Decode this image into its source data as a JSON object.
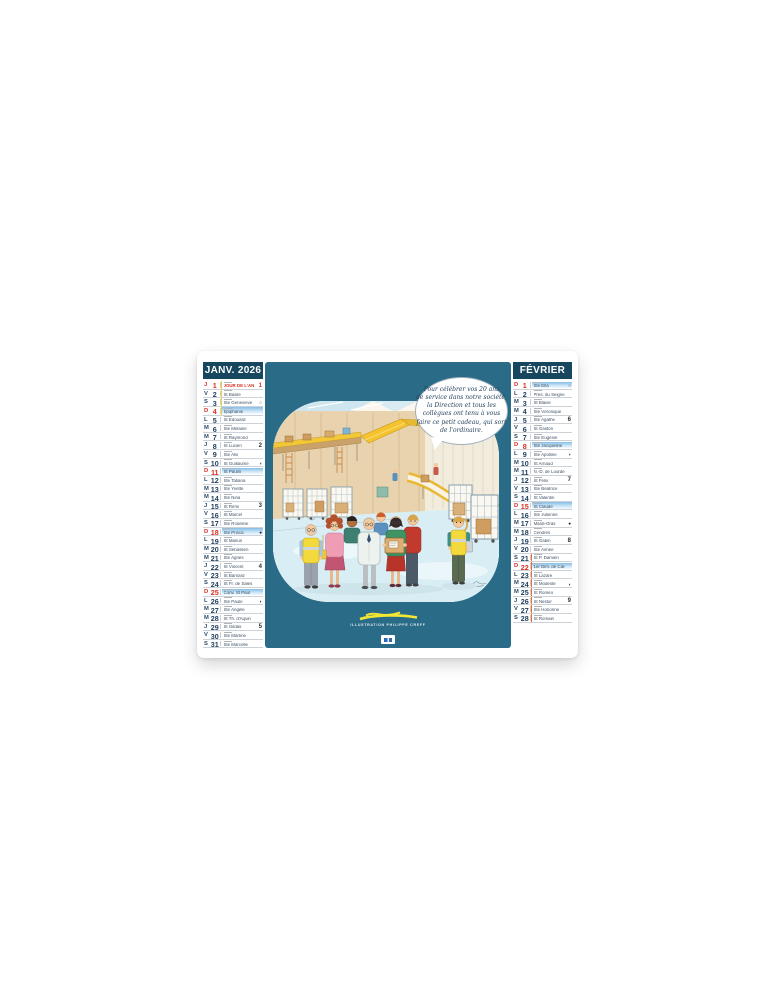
{
  "calendar": {
    "months": [
      {
        "title": "JANV. 2026",
        "days": [
          {
            "d": "J",
            "n": "1",
            "s": "JOUR DE L'AN",
            "red": true,
            "redSaint": true,
            "wk": "1",
            "wkRed": true,
            "bar": "yellow"
          },
          {
            "d": "V",
            "n": "2",
            "s": "St Basile",
            "bar": "yellow"
          },
          {
            "d": "S",
            "n": "3",
            "s": "Ste Geneviève",
            "moon": "full",
            "bar": "yellow"
          },
          {
            "d": "D",
            "n": "4",
            "s": "Épiphanie",
            "red": true,
            "sun": true,
            "bar": "yellow"
          },
          {
            "d": "L",
            "n": "5",
            "s": "St Édouard"
          },
          {
            "d": "M",
            "n": "6",
            "s": "Ste Mélaine"
          },
          {
            "d": "M",
            "n": "7",
            "s": "St Raymond"
          },
          {
            "d": "J",
            "n": "8",
            "s": "St Lucien",
            "wk": "2"
          },
          {
            "d": "V",
            "n": "9",
            "s": "Ste Alix"
          },
          {
            "d": "S",
            "n": "10",
            "s": "St Guillaume",
            "moon": "last"
          },
          {
            "d": "D",
            "n": "11",
            "s": "St Paulin",
            "red": true,
            "sun": true
          },
          {
            "d": "L",
            "n": "12",
            "s": "Ste Tatiana"
          },
          {
            "d": "M",
            "n": "13",
            "s": "Ste Yvette"
          },
          {
            "d": "M",
            "n": "14",
            "s": "Ste Nina"
          },
          {
            "d": "J",
            "n": "15",
            "s": "St Rémi",
            "wk": "3"
          },
          {
            "d": "V",
            "n": "16",
            "s": "St Marcel"
          },
          {
            "d": "S",
            "n": "17",
            "s": "Ste Roseline"
          },
          {
            "d": "D",
            "n": "18",
            "s": "Ste Prisca",
            "red": true,
            "sun": true,
            "moon": "new"
          },
          {
            "d": "L",
            "n": "19",
            "s": "St Marius"
          },
          {
            "d": "M",
            "n": "20",
            "s": "St Sébastien"
          },
          {
            "d": "M",
            "n": "21",
            "s": "Ste Agnès"
          },
          {
            "d": "J",
            "n": "22",
            "s": "St Vincent",
            "wk": "4"
          },
          {
            "d": "V",
            "n": "23",
            "s": "St Barnard"
          },
          {
            "d": "S",
            "n": "24",
            "s": "St Fr. de Sales"
          },
          {
            "d": "D",
            "n": "25",
            "s": "Conv. St Paul",
            "red": true,
            "sun": true
          },
          {
            "d": "L",
            "n": "26",
            "s": "Ste Paule",
            "moon": "first"
          },
          {
            "d": "M",
            "n": "27",
            "s": "Ste Angèle"
          },
          {
            "d": "M",
            "n": "28",
            "s": "St Th. d'Aquin"
          },
          {
            "d": "J",
            "n": "29",
            "s": "St Gildas",
            "wk": "5"
          },
          {
            "d": "V",
            "n": "30",
            "s": "Ste Martine"
          },
          {
            "d": "S",
            "n": "31",
            "s": "Ste Marcelle"
          }
        ]
      },
      {
        "title": "FÉVRIER",
        "days": [
          {
            "d": "D",
            "n": "1",
            "s": "Ste Ella",
            "red": true,
            "sun": true,
            "moon": "full"
          },
          {
            "d": "L",
            "n": "2",
            "s": "Prés. du Seigneur"
          },
          {
            "d": "M",
            "n": "3",
            "s": "St Blaise"
          },
          {
            "d": "M",
            "n": "4",
            "s": "Ste Véronique"
          },
          {
            "d": "J",
            "n": "5",
            "s": "Ste Agathe",
            "wk": "6"
          },
          {
            "d": "V",
            "n": "6",
            "s": "St Gaston"
          },
          {
            "d": "S",
            "n": "7",
            "s": "Ste Eugénie"
          },
          {
            "d": "D",
            "n": "8",
            "s": "Ste Jacqueline",
            "red": true,
            "sun": true
          },
          {
            "d": "L",
            "n": "9",
            "s": "Ste Apolline",
            "moon": "last"
          },
          {
            "d": "M",
            "n": "10",
            "s": "St Arnaud"
          },
          {
            "d": "M",
            "n": "11",
            "s": "N.-D. de Lourdes"
          },
          {
            "d": "J",
            "n": "12",
            "s": "St Félix",
            "wk": "7"
          },
          {
            "d": "V",
            "n": "13",
            "s": "Ste Béatrice"
          },
          {
            "d": "S",
            "n": "14",
            "s": "St Valentin"
          },
          {
            "d": "D",
            "n": "15",
            "s": "St Claude",
            "red": true,
            "sun": true
          },
          {
            "d": "L",
            "n": "16",
            "s": "Ste Julienne"
          },
          {
            "d": "M",
            "n": "17",
            "s": "Mardi-Gras",
            "moon": "new"
          },
          {
            "d": "M",
            "n": "18",
            "s": "Cendres"
          },
          {
            "d": "J",
            "n": "19",
            "s": "St Gabin",
            "wk": "8"
          },
          {
            "d": "V",
            "n": "20",
            "s": "Ste Aimée"
          },
          {
            "d": "S",
            "n": "21",
            "s": "St P. Damien",
            "bar": "orange"
          },
          {
            "d": "D",
            "n": "22",
            "s": "1er Dim. de Carême",
            "red": true,
            "sun": true,
            "bar": "orange"
          },
          {
            "d": "L",
            "n": "23",
            "s": "St Lazare",
            "bar": "orange"
          },
          {
            "d": "M",
            "n": "24",
            "s": "St Modeste",
            "moon": "first",
            "bar": "orange"
          },
          {
            "d": "M",
            "n": "25",
            "s": "St Roméo",
            "bar": "orange"
          },
          {
            "d": "J",
            "n": "26",
            "s": "St Nestor",
            "wk": "9",
            "bar": "orange"
          },
          {
            "d": "V",
            "n": "27",
            "s": "Ste Honorine",
            "bar": "orange"
          },
          {
            "d": "S",
            "n": "28",
            "s": "St Romain",
            "bar": "orange"
          }
        ]
      }
    ]
  },
  "moon_glyphs": {
    "full": "○",
    "last": "◖",
    "new": "●",
    "first": "◗"
  },
  "illustration": {
    "speech_bubble": "Pour célébrer vos 20 ans\nde service dans notre société,\nla Direction et tous les\ncollègues ont tenu à vous\nfaire ce petit cadeau, qui sort\nde l'ordinaire.",
    "credit_text": "ILLUSTRATION PHILIPPE CREFF"
  },
  "colors": {
    "panel_teal": "#2a6c88",
    "header_navy": "#17465f",
    "sunday_red": "#dc2e22",
    "sunday_band_blue": "#86bde5",
    "holiday_yellow": "#f2d32e",
    "holiday_orange": "#ec6f2d",
    "conveyor_yellow": "#f2c838",
    "logo_yellow": "#f2e833"
  }
}
